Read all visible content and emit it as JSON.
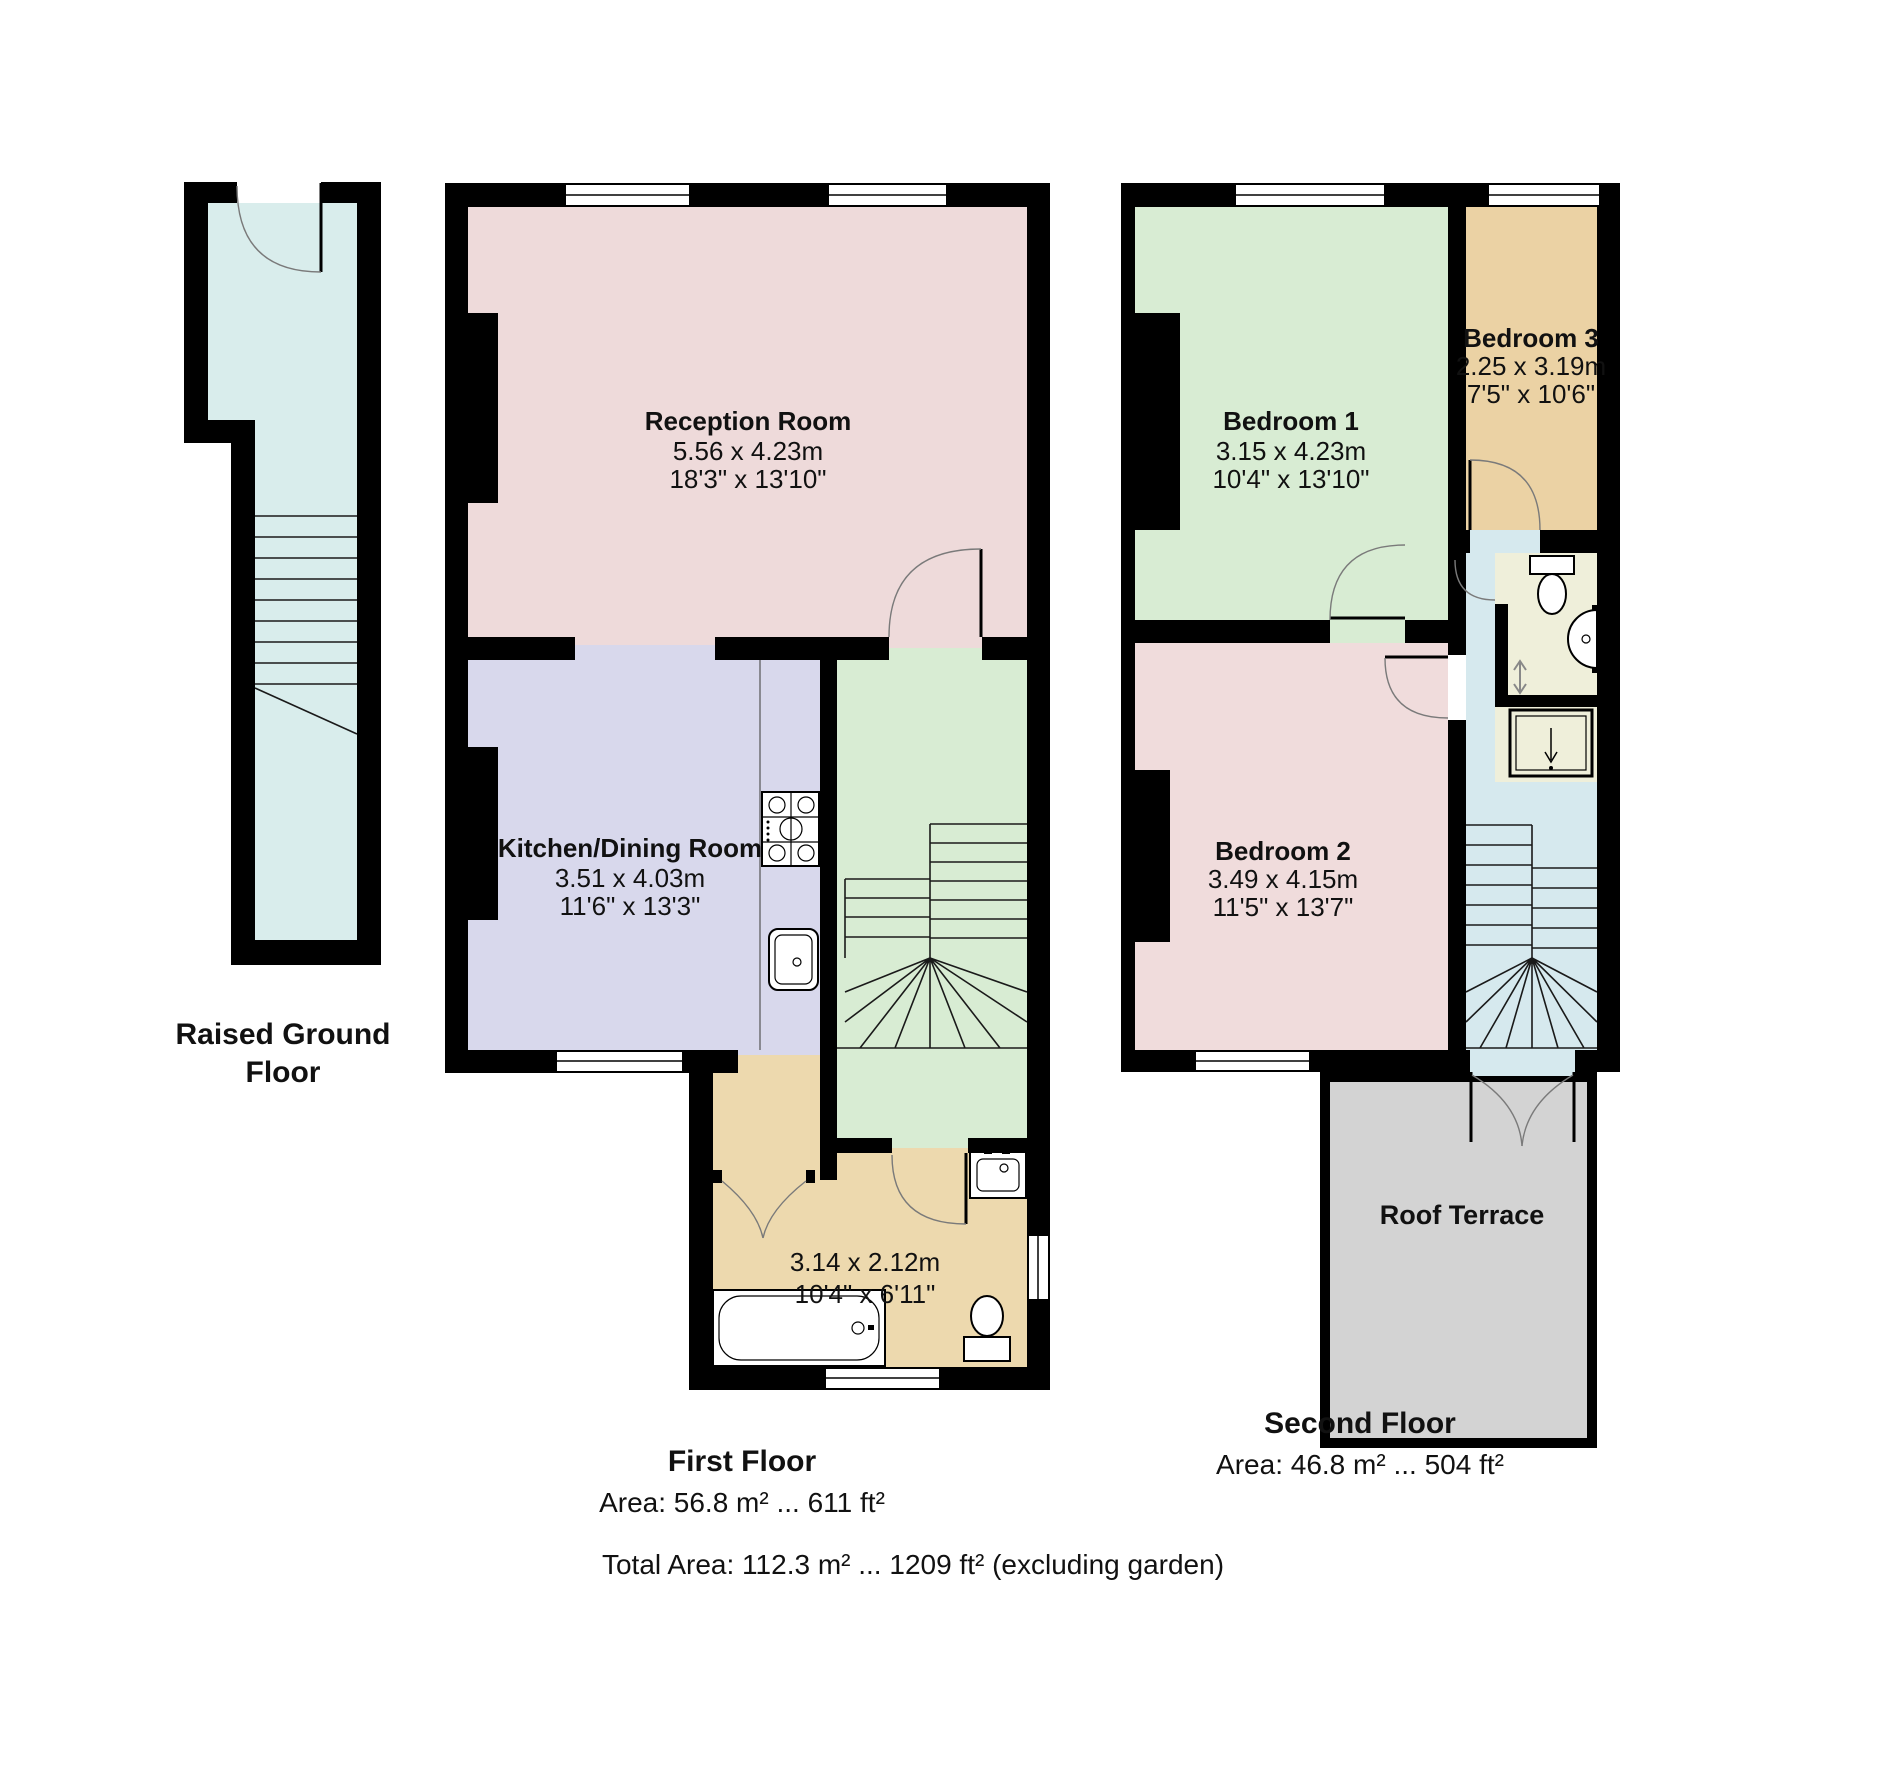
{
  "colors": {
    "wall": "#000000",
    "hallway_rg": "#d9edec",
    "reception": "#eedada",
    "kitchen": "#d8d8ec",
    "stair_hall": "#d8ecd3",
    "bath_first": "#edd9ae",
    "bedroom1": "#d8ecd3",
    "bedroom2": "#f0dcdc",
    "bedroom3": "#ebd2a4",
    "landing": "#d6e9ee",
    "bath_second": "#efefda",
    "terrace": "#d3d3d3"
  },
  "floors": {
    "raised_ground": {
      "label_line1": "Raised Ground",
      "label_line2": "Floor"
    },
    "first": {
      "label": "First Floor",
      "area": "Area: 56.8 m² ... 611 ft²",
      "rooms": {
        "reception": {
          "name": "Reception Room",
          "dim_m": "5.56 x 4.23m",
          "dim_ft": "18'3\" x 13'10\""
        },
        "kitchen": {
          "name": "Kitchen/Dining Room",
          "dim_m": "3.51 x 4.03m",
          "dim_ft": "11'6\" x 13'3\""
        },
        "bathroom": {
          "dim_m": "3.14 x 2.12m",
          "dim_ft": "10'4\" x 6'11\""
        }
      }
    },
    "second": {
      "label": "Second Floor",
      "area": "Area: 46.8 m² ... 504 ft²",
      "rooms": {
        "bedroom1": {
          "name": "Bedroom 1",
          "dim_m": "3.15 x 4.23m",
          "dim_ft": "10'4\" x 13'10\""
        },
        "bedroom2": {
          "name": "Bedroom 2",
          "dim_m": "3.49 x 4.15m",
          "dim_ft": "11'5\" x 13'7\""
        },
        "bedroom3": {
          "name": "Bedroom 3",
          "dim_m": "2.25 x 3.19m",
          "dim_ft": "7'5\" x 10'6\""
        },
        "roof_terrace": {
          "name": "Roof Terrace"
        }
      }
    }
  },
  "total_area": "Total Area: 112.3 m² ... 1209 ft² (excluding garden)"
}
